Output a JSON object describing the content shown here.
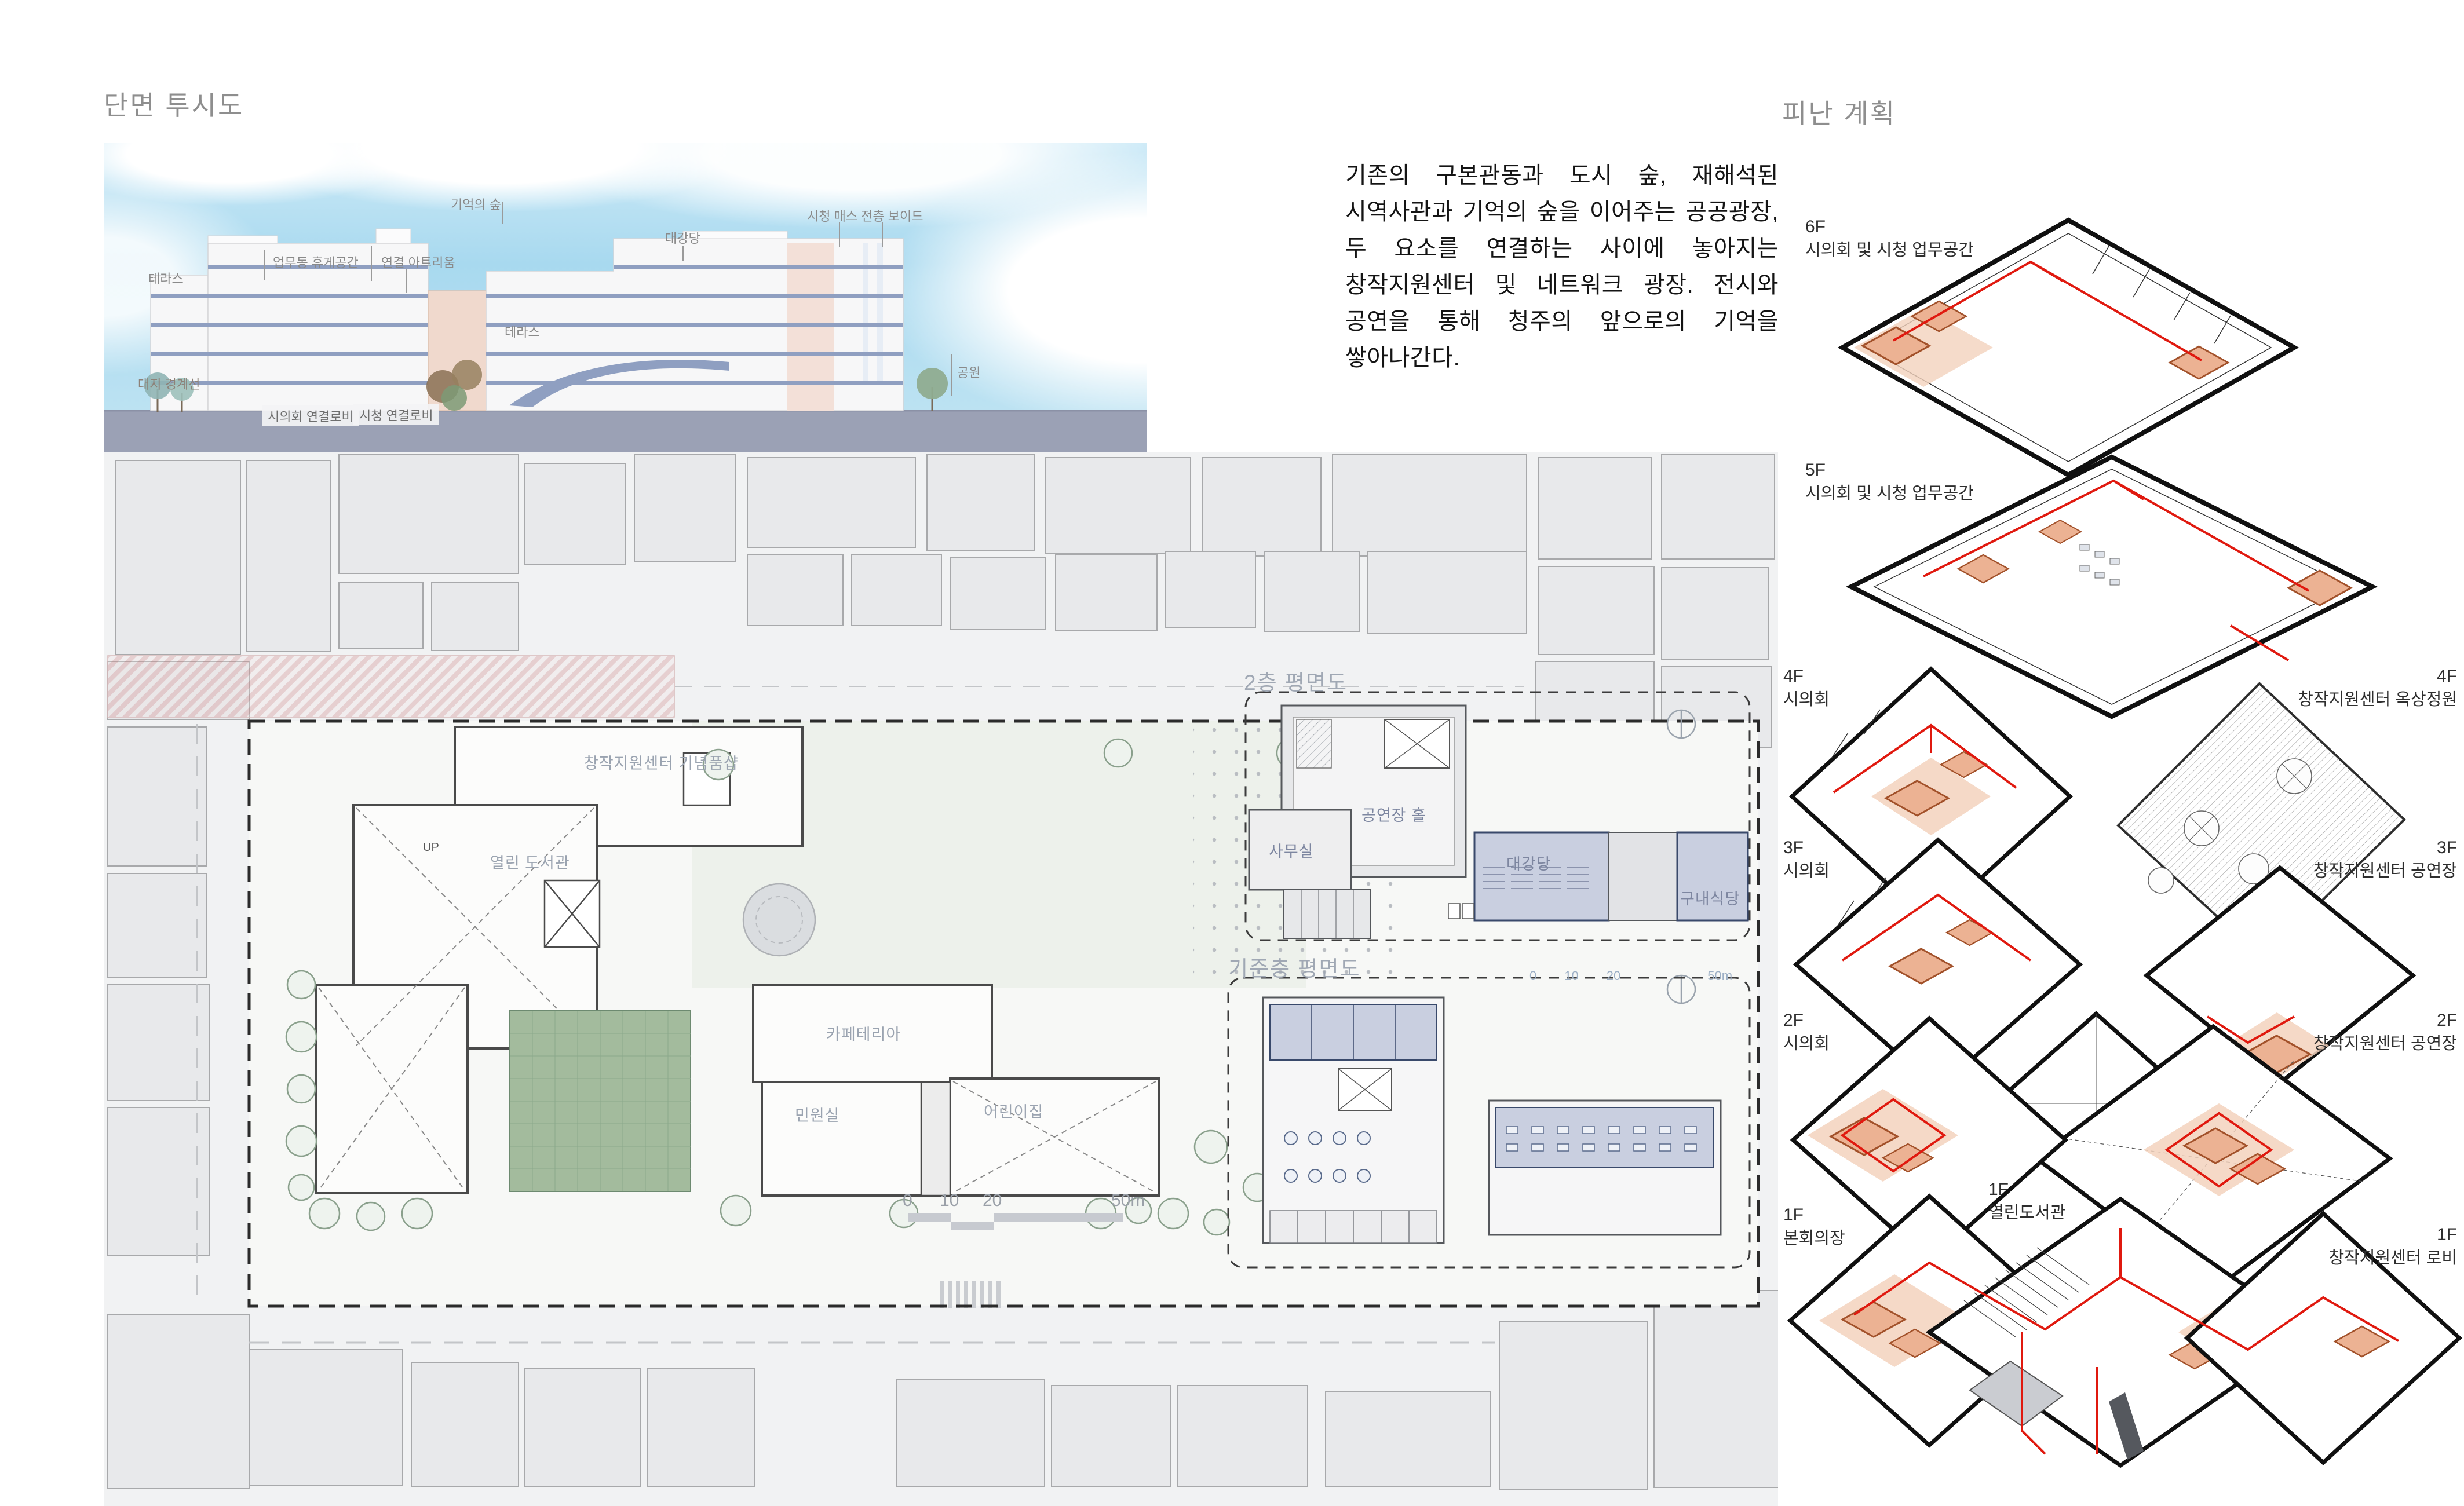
{
  "section": {
    "title": "단면 투시도",
    "labels": {
      "memory_forest": "기억의 숲",
      "cityhall_void": "시청 매스 전층 보이드",
      "auditorium": "대강당",
      "office_lounge": "업무동 휴게공간",
      "link_atrium": "연결 아트리움",
      "terrace_a": "테라스",
      "terrace_b": "테라스",
      "site_boundary": "대지 경계선",
      "council_link_lobby": "시의회 연결로비",
      "cityhall_link_lobby": "시청 연결로비",
      "park": "공원"
    }
  },
  "description": {
    "text": "기존의 구본관동과 도시 숲, 재해석된 시역사관과 기억의 숲을 이어주는 공공광장, 두 요소를 연결하는 사이에 놓아지는 창작지원센터 및 네트워크 광장. 전시와 공연을 통해 청주의 앞으로의 기억을 쌓아나간다."
  },
  "site_plan": {
    "title": "1층 배치 평면도",
    "rooms": {
      "open_library": "열린 도서관",
      "gift_shop": "창작지원센터 기념품샵",
      "cafeteria": "카페테리아",
      "civil_office": "민원실",
      "daycare": "어린이집",
      "up": "UP"
    },
    "scalebar": {
      "t0": "0",
      "t10": "10",
      "t20": "20",
      "t50": "50m"
    }
  },
  "insets": {
    "second_floor": {
      "title": "2층 평면도",
      "hall": "공연장 홀",
      "office": "사무실",
      "auditorium": "대강당",
      "cafeteria": "구내식당"
    },
    "typical_floor": {
      "title": "기준층 평면도"
    }
  },
  "evacuation": {
    "title": "피난 계획",
    "floors": [
      {
        "id": "6F",
        "name": "시의회 및 시청 업무공간"
      },
      {
        "id": "5F",
        "name": "시의회 및 시청 업무공간"
      },
      {
        "id": "4F",
        "name": "시의회"
      },
      {
        "id": "4F",
        "name": "창작지원센터 옥상정원"
      },
      {
        "id": "3F",
        "name": "시의회"
      },
      {
        "id": "3F",
        "name": "창작지원센터 공연장"
      },
      {
        "id": "2F",
        "name": "시의회"
      },
      {
        "id": "2F",
        "name": "창작지원센터 공연장"
      },
      {
        "id": "1F",
        "name": "본회의장"
      },
      {
        "id": "1F",
        "name": "열린도서관"
      },
      {
        "id": "1F",
        "name": "창작지원센터 로비"
      }
    ]
  },
  "colors": {
    "sky": "#a9d9ee",
    "slab_blue": "#8f9fc1",
    "evac_red": "#e0190f",
    "evac_room_orange": "#ecb293",
    "plan_blue": "#c9cfe0",
    "site_green": "#a3bb9d",
    "pink_road": "#e3bebe"
  }
}
